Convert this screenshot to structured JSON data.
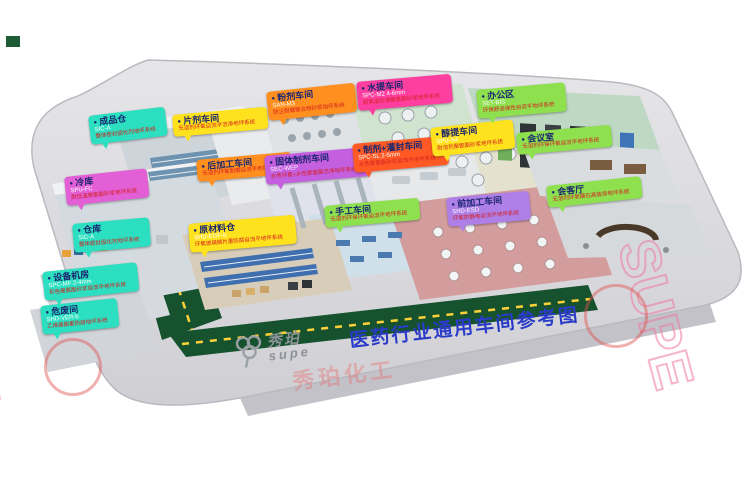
{
  "meta": {
    "title": "医药行业通用车间参考图"
  },
  "logo": {
    "name_cn": "秀珀",
    "name_en": "supe",
    "icon": "clover-logo-icon"
  },
  "watermark": {
    "text": "SUPE",
    "stamp_text": "秀珀化工"
  },
  "colors": {
    "title_blue": "#2a3bc8",
    "road_green": "#16522e",
    "road_dash_yellow": "#ffd23a",
    "platform_gray": "#d9d9dc",
    "label_teal": "#2bdfc0",
    "label_magenta": "#e35fd6",
    "label_yellow": "#ffe21e",
    "label_orange": "#ff8f1f",
    "label_orangered": "#ff5a26",
    "label_pink": "#ff3fa0",
    "label_purple": "#c45fe0",
    "label_lightpurple": "#af7fe8",
    "label_green": "#8fe04f"
  },
  "labels": [
    {
      "id": "chengpincang",
      "title": "成品仓",
      "code": "SIC-A",
      "desc": "整体密封固化剂地坪系统",
      "color": "#2bdfc0",
      "x": 88,
      "y": 116,
      "rot": -7
    },
    {
      "id": "lengku",
      "title": "冷库",
      "code": "SPU-FC",
      "desc": "耐低温聚氨酯砂浆地坪系统",
      "color": "#e35fd6",
      "x": 64,
      "y": 177,
      "rot": -6
    },
    {
      "id": "cangku",
      "title": "仓库",
      "code": "SIC-A",
      "desc": "整体密封固化剂地坪系统",
      "color": "#2bdfc0",
      "x": 72,
      "y": 224,
      "rot": -5
    },
    {
      "id": "shebeijifang",
      "title": "设备机房",
      "code": "SPC-MF 2-4mm",
      "desc": "彩色聚氨酯砂浆自流平地坪系统",
      "color": "#2bdfc0",
      "x": 42,
      "y": 272,
      "rot": -6
    },
    {
      "id": "weifeijian",
      "title": "危废间",
      "code": "SHD-VER-b",
      "desc": "乙烯基酯重防腐地坪系统",
      "color": "#2bdfc0",
      "x": 40,
      "y": 306,
      "rot": -6
    },
    {
      "id": "pianji",
      "title": "片剂车间",
      "code": "",
      "desc": "无溶剂环氧自流平洁净地坪系统",
      "color": "#ffe21e",
      "x": 172,
      "y": 115,
      "rot": -5
    },
    {
      "id": "houjiagong",
      "title": "后加工车间",
      "code": "",
      "desc": "无溶剂环氧耐磨自流平地坪系统",
      "color": "#ff8f1f",
      "x": 196,
      "y": 160,
      "rot": -5
    },
    {
      "id": "fenji",
      "title": "粉剂车间",
      "code": "SAN-M3",
      "desc": "防尘耐磨聚合物砂浆地坪系统",
      "color": "#ff8f1f",
      "x": 266,
      "y": 92,
      "rot": -6
    },
    {
      "id": "gutizhiji",
      "title": "固体制剂车间",
      "code": "SEC-WEP",
      "desc": "水性环氧+水性聚氨酯洁净地坪系统",
      "color": "#c45fe0",
      "x": 264,
      "y": 156,
      "rot": -5
    },
    {
      "id": "shougong",
      "title": "手工车间",
      "code": "",
      "desc": "无溶剂环保环氧自流平地坪系统",
      "color": "#8fe04f",
      "x": 324,
      "y": 206,
      "rot": -5
    },
    {
      "id": "yuancailiao",
      "title": "原材料仓",
      "code": "SHD-EGF-b",
      "desc": "环氧玻璃鳞片重防腐自流平地坪系统",
      "color": "#ffe21e",
      "x": 188,
      "y": 224,
      "rot": -5
    },
    {
      "id": "shuiti",
      "title": "水提车间",
      "code": "SPC-M2 4-6mm",
      "desc": "耐高温防滑聚氨酯砂浆地坪系统",
      "color": "#ff3fa0",
      "x": 356,
      "y": 82,
      "rot": -5
    },
    {
      "id": "zhijiguanfeng",
      "title": "制剂+灌封车间",
      "code": "SPC-SL 2-5mm",
      "desc": "水性聚氨酯砂浆自流平地坪系统",
      "color": "#ff5a26",
      "x": 352,
      "y": 144,
      "rot": -5
    },
    {
      "id": "chunti",
      "title": "醇提车间",
      "code": "SPU-S4",
      "desc": "耐溶剂聚氨酯砂浆地坪系统",
      "color": "#ffe21e",
      "x": 430,
      "y": 128,
      "rot": -6
    },
    {
      "id": "qianjiagong",
      "title": "前加工车间",
      "code": "SHD-ESD",
      "desc": "环氧防静电自流平地坪系统",
      "color": "#af7fe8",
      "x": 446,
      "y": 198,
      "rot": -5
    },
    {
      "id": "bangongqu",
      "title": "办公区",
      "code": "SET-BIS",
      "desc": "环保舒适弹性自流平地坪系统",
      "color": "#8fe04f",
      "x": 476,
      "y": 90,
      "rot": -5
    },
    {
      "id": "huiyishi",
      "title": "会议室",
      "code": "",
      "desc": "无溶剂环保环氧自流平地坪系统",
      "color": "#8fe04f",
      "x": 516,
      "y": 133,
      "rot": -5
    },
    {
      "id": "huiketing",
      "title": "会客厅",
      "code": "",
      "desc": "无溶剂环氧磨石高装饰地坪系统",
      "color": "#8fe04f",
      "x": 546,
      "y": 186,
      "rot": -6
    }
  ]
}
